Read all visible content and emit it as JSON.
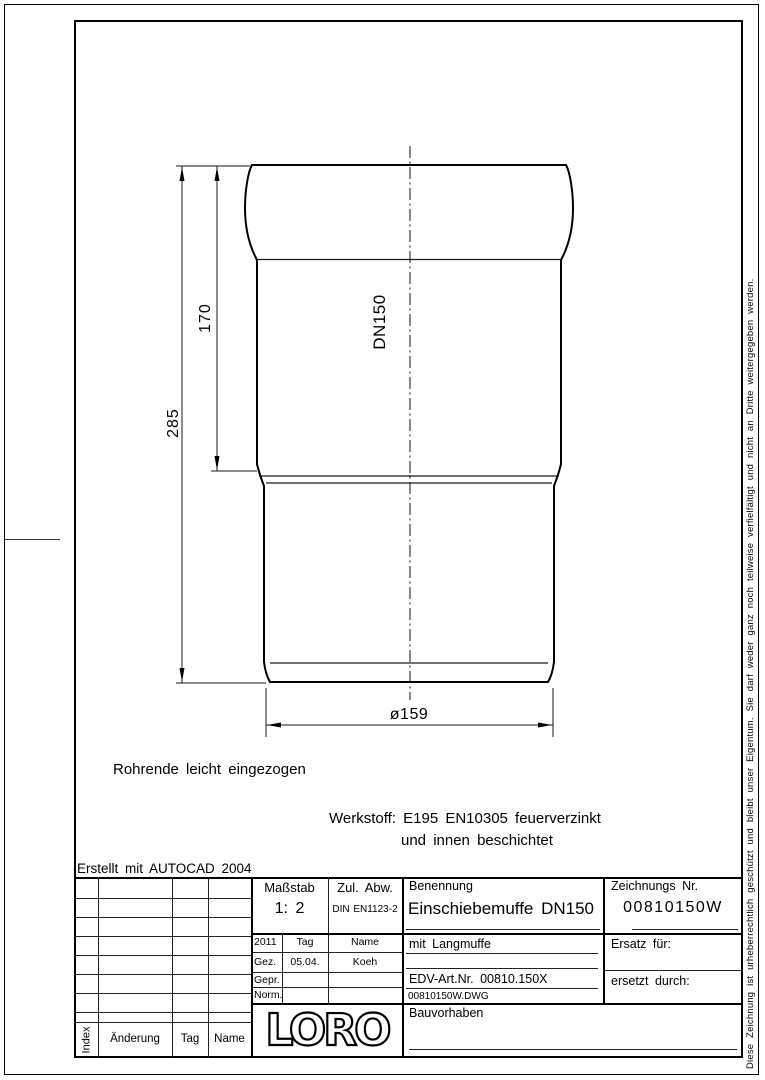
{
  "page": {
    "erstellt_note": "Erstellt mit AUTOCAD 2004",
    "drawing_note": "Rohrende leicht eingezogen",
    "werkstoff_line1": "Werkstoff: E195 EN10305 feuerverzinkt",
    "werkstoff_line2": "und innen beschichtet",
    "copyright_vertical": "Diese Zeichnung ist urheberrechtlich geschützt und bleibt unser Eigentum. Sie darf weder ganz noch teilweise verfielfältigt und nicht an Dritte weitergegeben werden."
  },
  "drawing": {
    "dim_total_length": "285",
    "dim_socket_length": "170",
    "pipe_label": "DN150",
    "dim_diameter": "ø159"
  },
  "title_block": {
    "masstab": {
      "label": "Maßstab",
      "value": "1: 2"
    },
    "zul_abw": {
      "label": "Zul. Abw.",
      "value": "DIN EN1123-2"
    },
    "benennung": {
      "label": "Benennung",
      "value": "Einschiebemuffe DN150",
      "subtitle": "mit Langmuffe",
      "edv_art_nr": "EDV-Art.Nr. 00810.150X",
      "dwg_file": "00810150W.DWG"
    },
    "zeichnungs_nr": {
      "label": "Zeichnungs Nr.",
      "value": "00810150W"
    },
    "ersatz_fuer": "Ersatz für:",
    "ersetzt_durch": "ersetzt durch:",
    "bauvorhaben": "Bauvorhaben",
    "logo": "LORO",
    "approval": {
      "year": "2011",
      "tag_header": "Tag",
      "name_header": "Name",
      "gez": {
        "label": "Gez.",
        "tag": "05.04.",
        "name": "Koeh"
      },
      "gepr": {
        "label": "Gepr."
      },
      "norm": {
        "label": "Norm."
      }
    }
  },
  "revision_table": {
    "headers": {
      "index": "Index",
      "aenderung": "Änderung",
      "tag": "Tag",
      "name": "Name"
    }
  },
  "colors": {
    "line": "#000000",
    "background": "#ffffff"
  }
}
